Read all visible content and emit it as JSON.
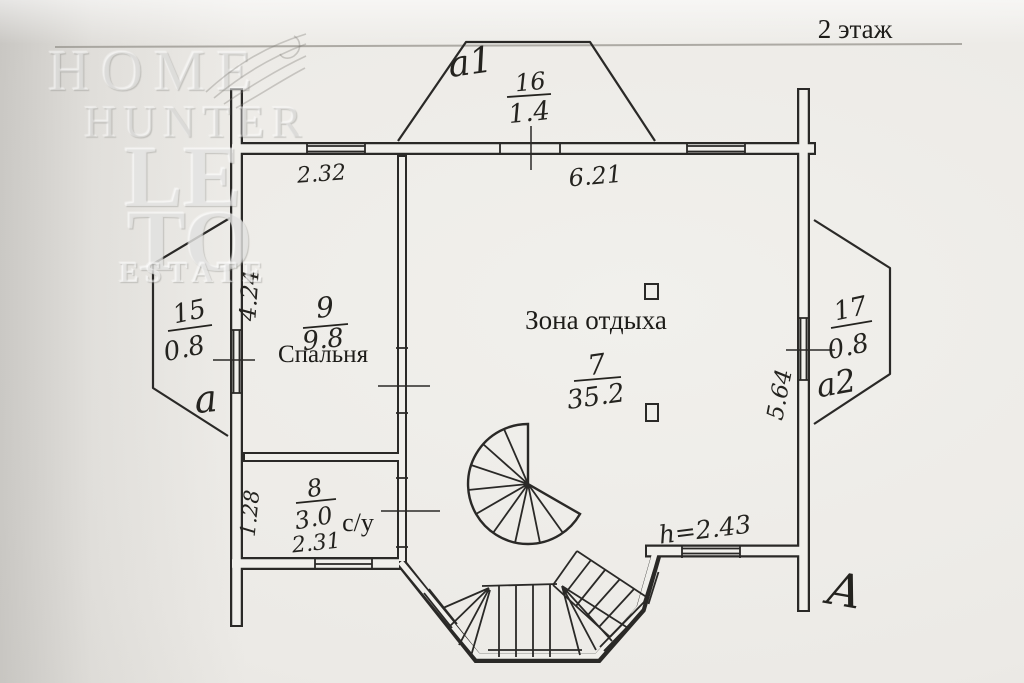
{
  "floor_title": "2 этаж",
  "watermark": {
    "home": "HOME",
    "hunter": "HUNTER",
    "le": "LE",
    "to": "TO",
    "estate": "ESTATE"
  },
  "rooms": {
    "balcony_top": {
      "label": "a1",
      "number": "16",
      "area": "1.4"
    },
    "bay_left": {
      "label": "a",
      "number": "15",
      "area": "0.8"
    },
    "bedroom": {
      "name": "Спальня",
      "number": "9",
      "area": "9.8"
    },
    "lounge": {
      "name": "Зона отдыха",
      "number": "7",
      "area": "35.2"
    },
    "bay_right": {
      "label": "a2",
      "number": "17",
      "area": "0.8"
    },
    "bathroom": {
      "name": "с/у",
      "number": "8",
      "area": "3.0"
    }
  },
  "dimensions": {
    "top_wall_left": "2.32",
    "top_wall_right": "6.21",
    "bedroom_left": "4.24",
    "bathroom_left": "1.28",
    "bathroom_bottom": "2.31",
    "right_wall": "5.64",
    "ceiling_height": "h=2.43"
  },
  "signature": "A",
  "colors": {
    "ink": "#2a2927",
    "paper": "#f0efeb"
  }
}
